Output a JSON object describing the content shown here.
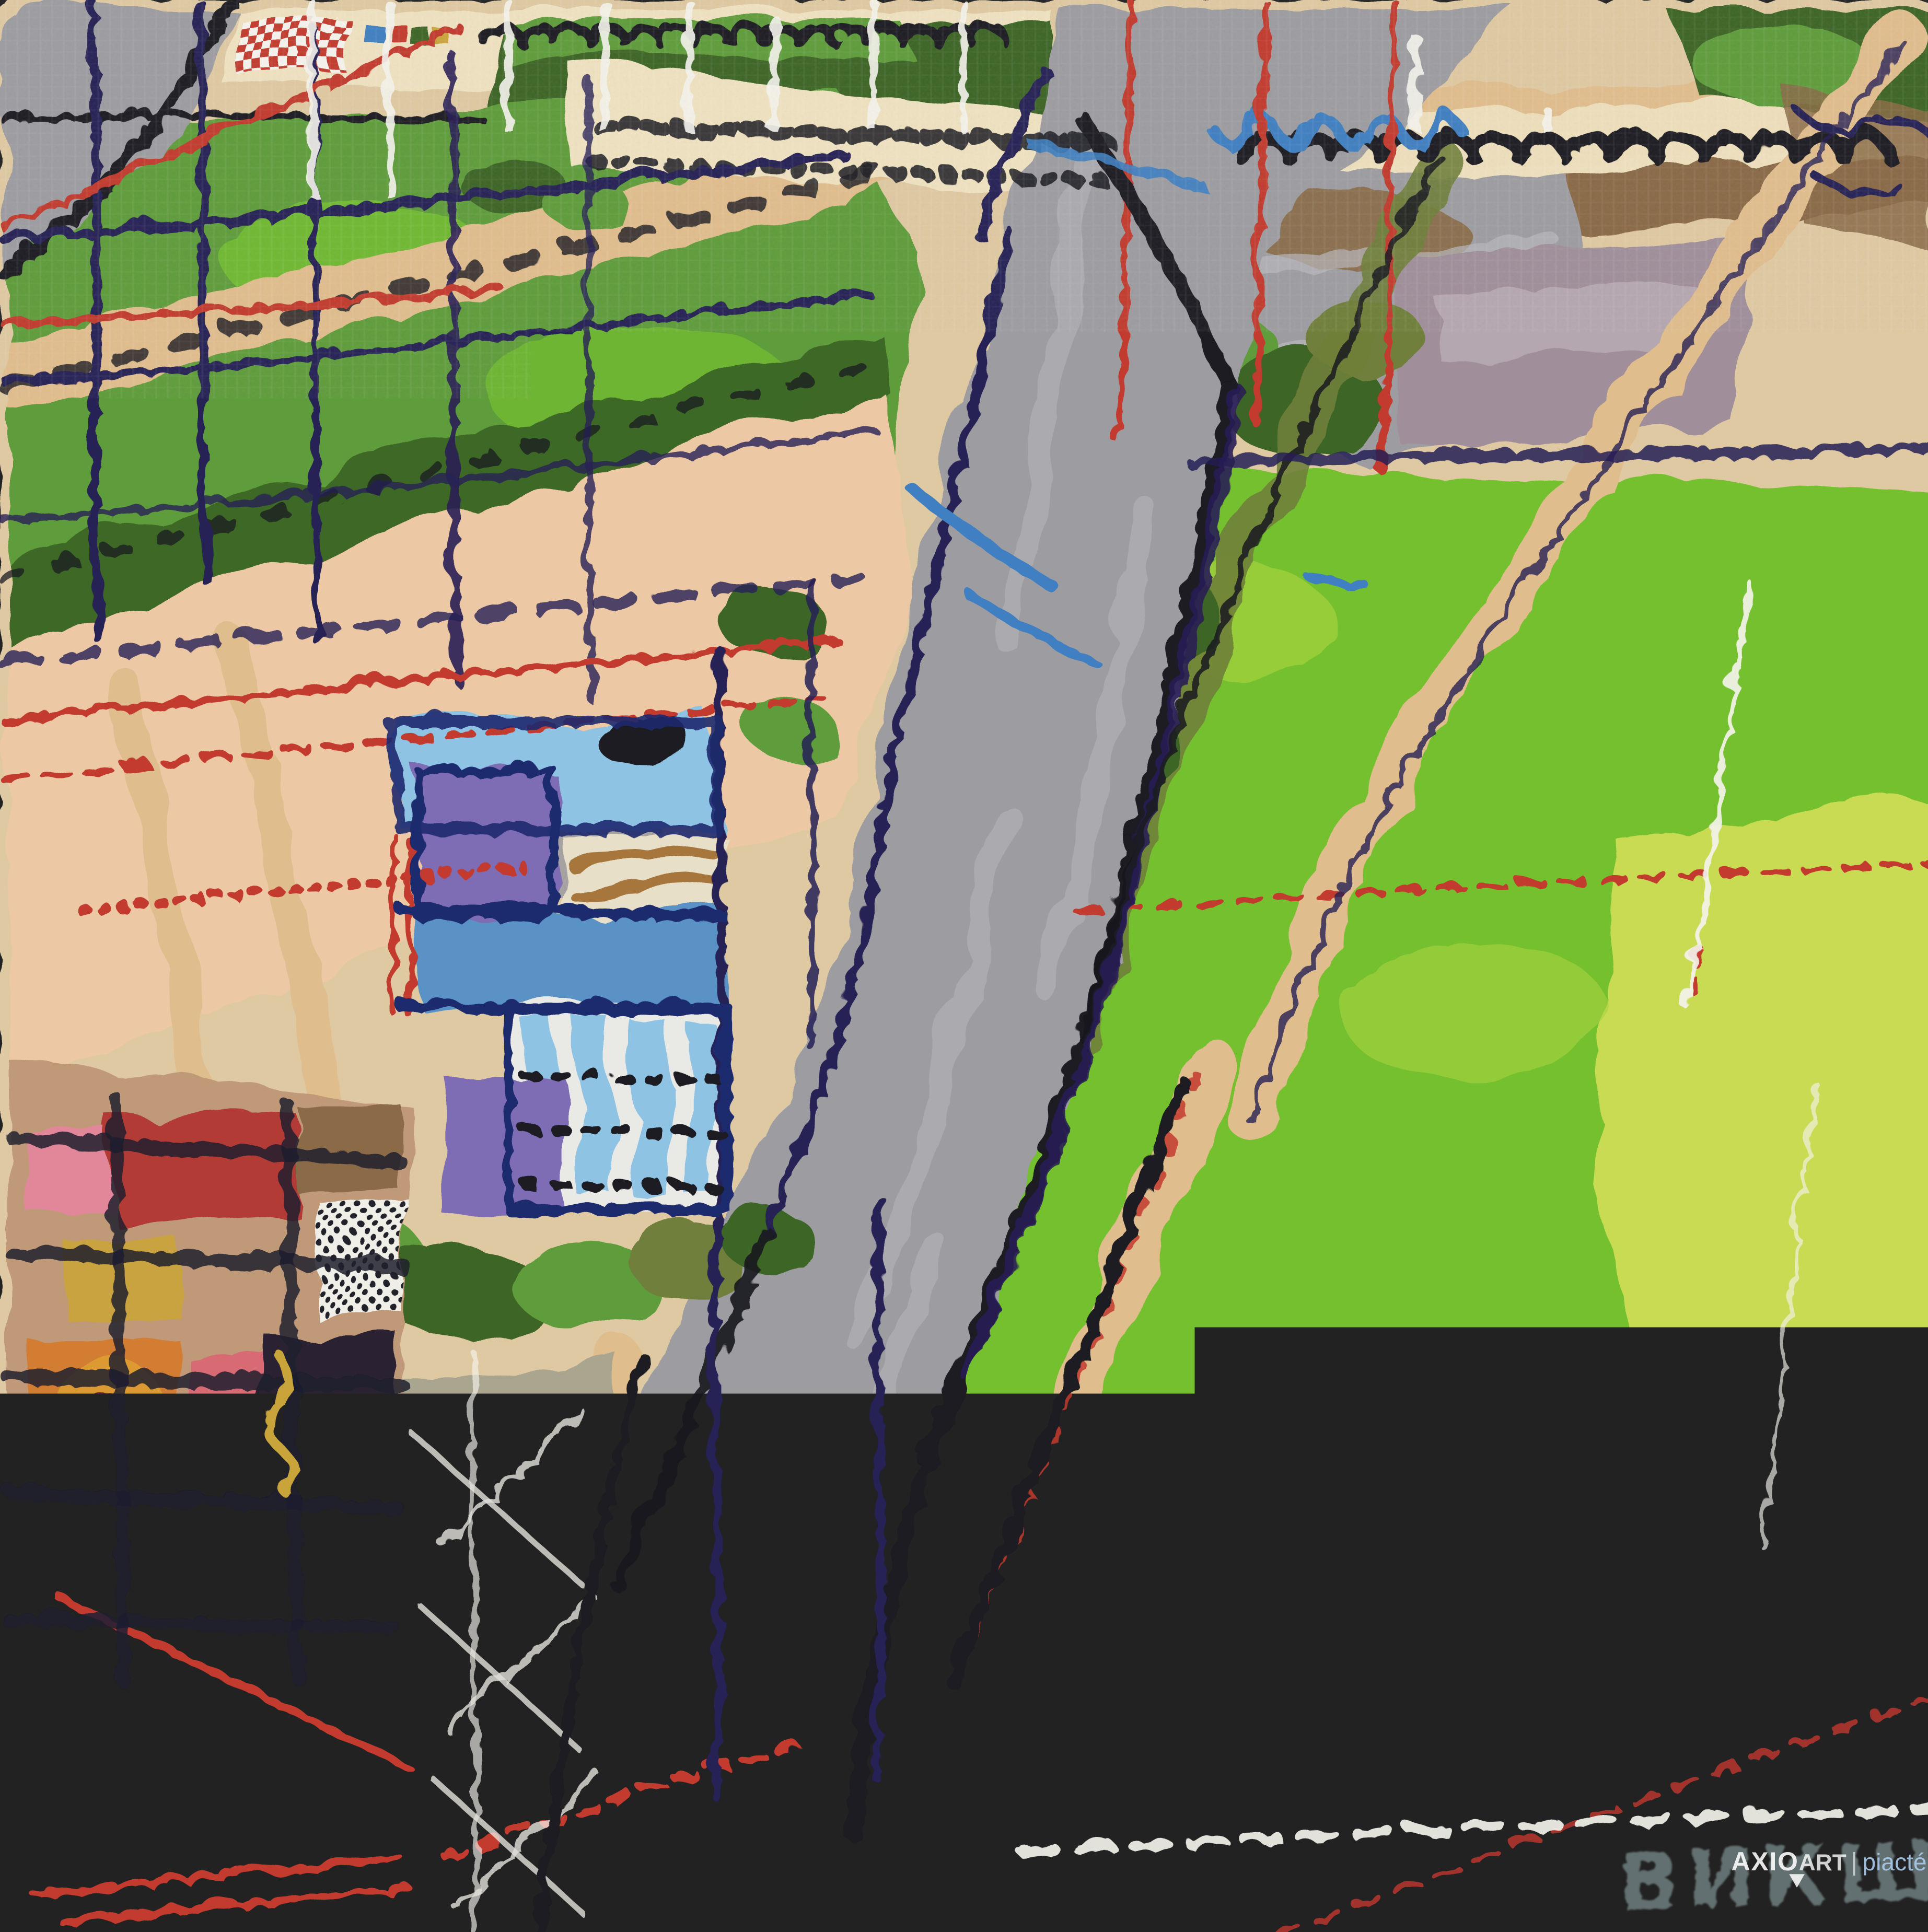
{
  "artwork": {
    "description": "Abstract mixed-media painting: aerial map view of a riverside city — gray river curving between bright green parks, tan roads, textile patchwork blocks, a blue building, a yellow field, with navy, red and white drip linework",
    "signature": {
      "text": "ВИКШaN",
      "color": "#7d8f90"
    },
    "watermark": {
      "brand_primary": "AXIO",
      "brand_secondary": "ART",
      "separator": "|",
      "tagline": "piactér",
      "brand_color": "#ffffff",
      "tagline_color": "#a9c9e9"
    }
  },
  "palette": {
    "canvas-base": "#dfc9a2",
    "river-gray": "#9d9da1",
    "river-light": "#b8b7bb",
    "river-dark": "#8b8b90",
    "park-green": "#74c02f",
    "park-light": "#a9d43f",
    "park-yellow": "#c9db52",
    "green-mid": "#5f9c3a",
    "green-dark": "#3c6527",
    "green-olive": "#6f7f3a",
    "road-tan": "#e0bd8d",
    "peach": "#ecc9a4",
    "cream": "#efe2c0",
    "salmon": "#e7b39b",
    "navy": "#272055",
    "ink": "#1a1a20",
    "red": "#c23a2e",
    "crimson": "#a83028",
    "white-paint": "#f5f3ec",
    "blue": "#3f7fc1",
    "sky-blue": "#8ec3e4",
    "steel-blue": "#5a92c6",
    "purple": "#7e6cb4",
    "deep-navy": "#1e2a6e",
    "mauve": "#a08f9a",
    "brown": "#8a6b46",
    "gold": "#c9a43a",
    "orange": "#d47a2a",
    "patch-red": "#b33a34",
    "patch-pink": "#e2879a",
    "patch-rose": "#d76a72",
    "patch-maroon": "#6e2430",
    "yellow": "#e7d44b",
    "slate": "#44505e",
    "khaki": "#aaa58f",
    "patch-base": "#c09a78",
    "sig": "#7d8f90",
    "wm-white": "#ffffff",
    "wm-blue": "#a9c9e9"
  }
}
